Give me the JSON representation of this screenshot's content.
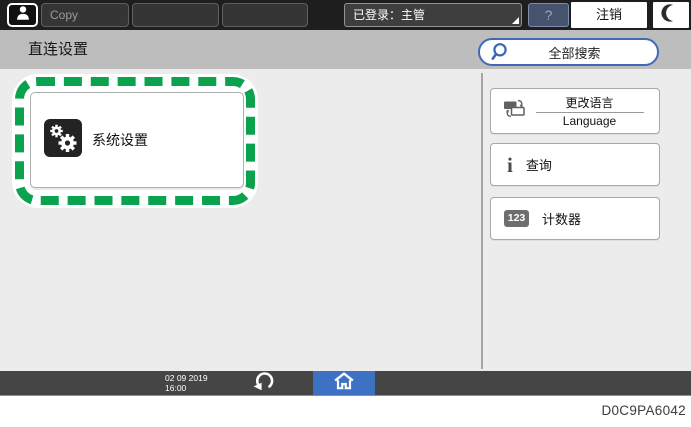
{
  "topbar": {
    "tabs": [
      {
        "label": "Copy"
      },
      {
        "label": ""
      },
      {
        "label": ""
      }
    ],
    "login_status": "已登录：主管",
    "help_label": "?",
    "logout_label": "注销"
  },
  "header": {
    "title": "直连设置",
    "search_label": "全部搜索"
  },
  "main": {
    "system_settings_label": "系统设置"
  },
  "right_panel": {
    "buttons": [
      {
        "label_primary": "更改语言",
        "label_secondary": "Language"
      },
      {
        "label": "查询"
      },
      {
        "label": "计数器",
        "icon_text": "123"
      }
    ]
  },
  "bottombar": {
    "date": "02 09 2019",
    "time": "16:00"
  },
  "caption": "D0C9PA6042",
  "icons": {
    "user": "user-icon",
    "moon": "moon-icon",
    "search": "search-icon",
    "gears": "gears-icon",
    "language": "language-icon",
    "info": "info-icon",
    "counter": "counter-icon",
    "back": "back-icon",
    "home": "home-icon"
  },
  "colors": {
    "highlight_green": "#0ba24d",
    "accent_blue": "#3e6ab8",
    "home_blue": "#3d71c3",
    "topbar_dark": "#1e1e1e",
    "titlebar_grey": "#bdbdbd",
    "content_grey": "#ececec",
    "bottombar_grey": "#454545"
  }
}
